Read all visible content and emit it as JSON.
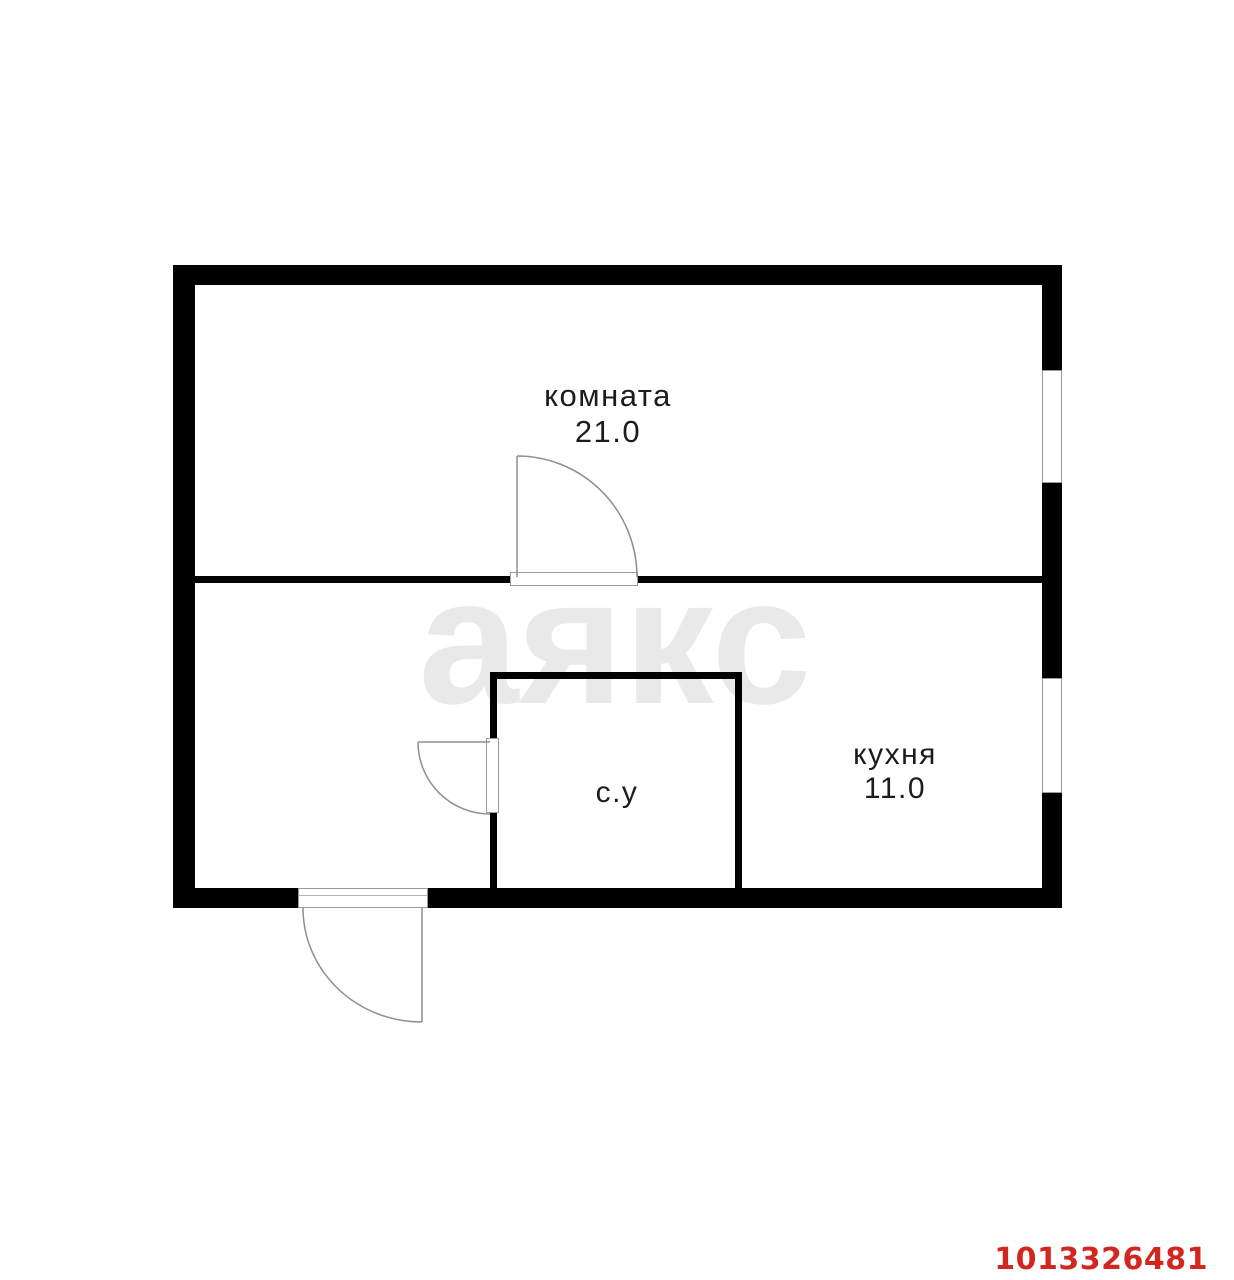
{
  "floorplan": {
    "rooms": {
      "living": {
        "name": "комната",
        "area": "21.0"
      },
      "kitchen": {
        "name": "кухня",
        "area": "11.0"
      },
      "bathroom": {
        "name": "с.у"
      }
    },
    "watermark_text": "аякс",
    "listing_id": "1013326481"
  },
  "colors": {
    "background": "#ffffff",
    "wall": "#000000",
    "thin_line": "#8f8f8f",
    "label_text": "#1c1c1c",
    "watermark": "#e9e9e9",
    "listing_id": "#d22720"
  }
}
